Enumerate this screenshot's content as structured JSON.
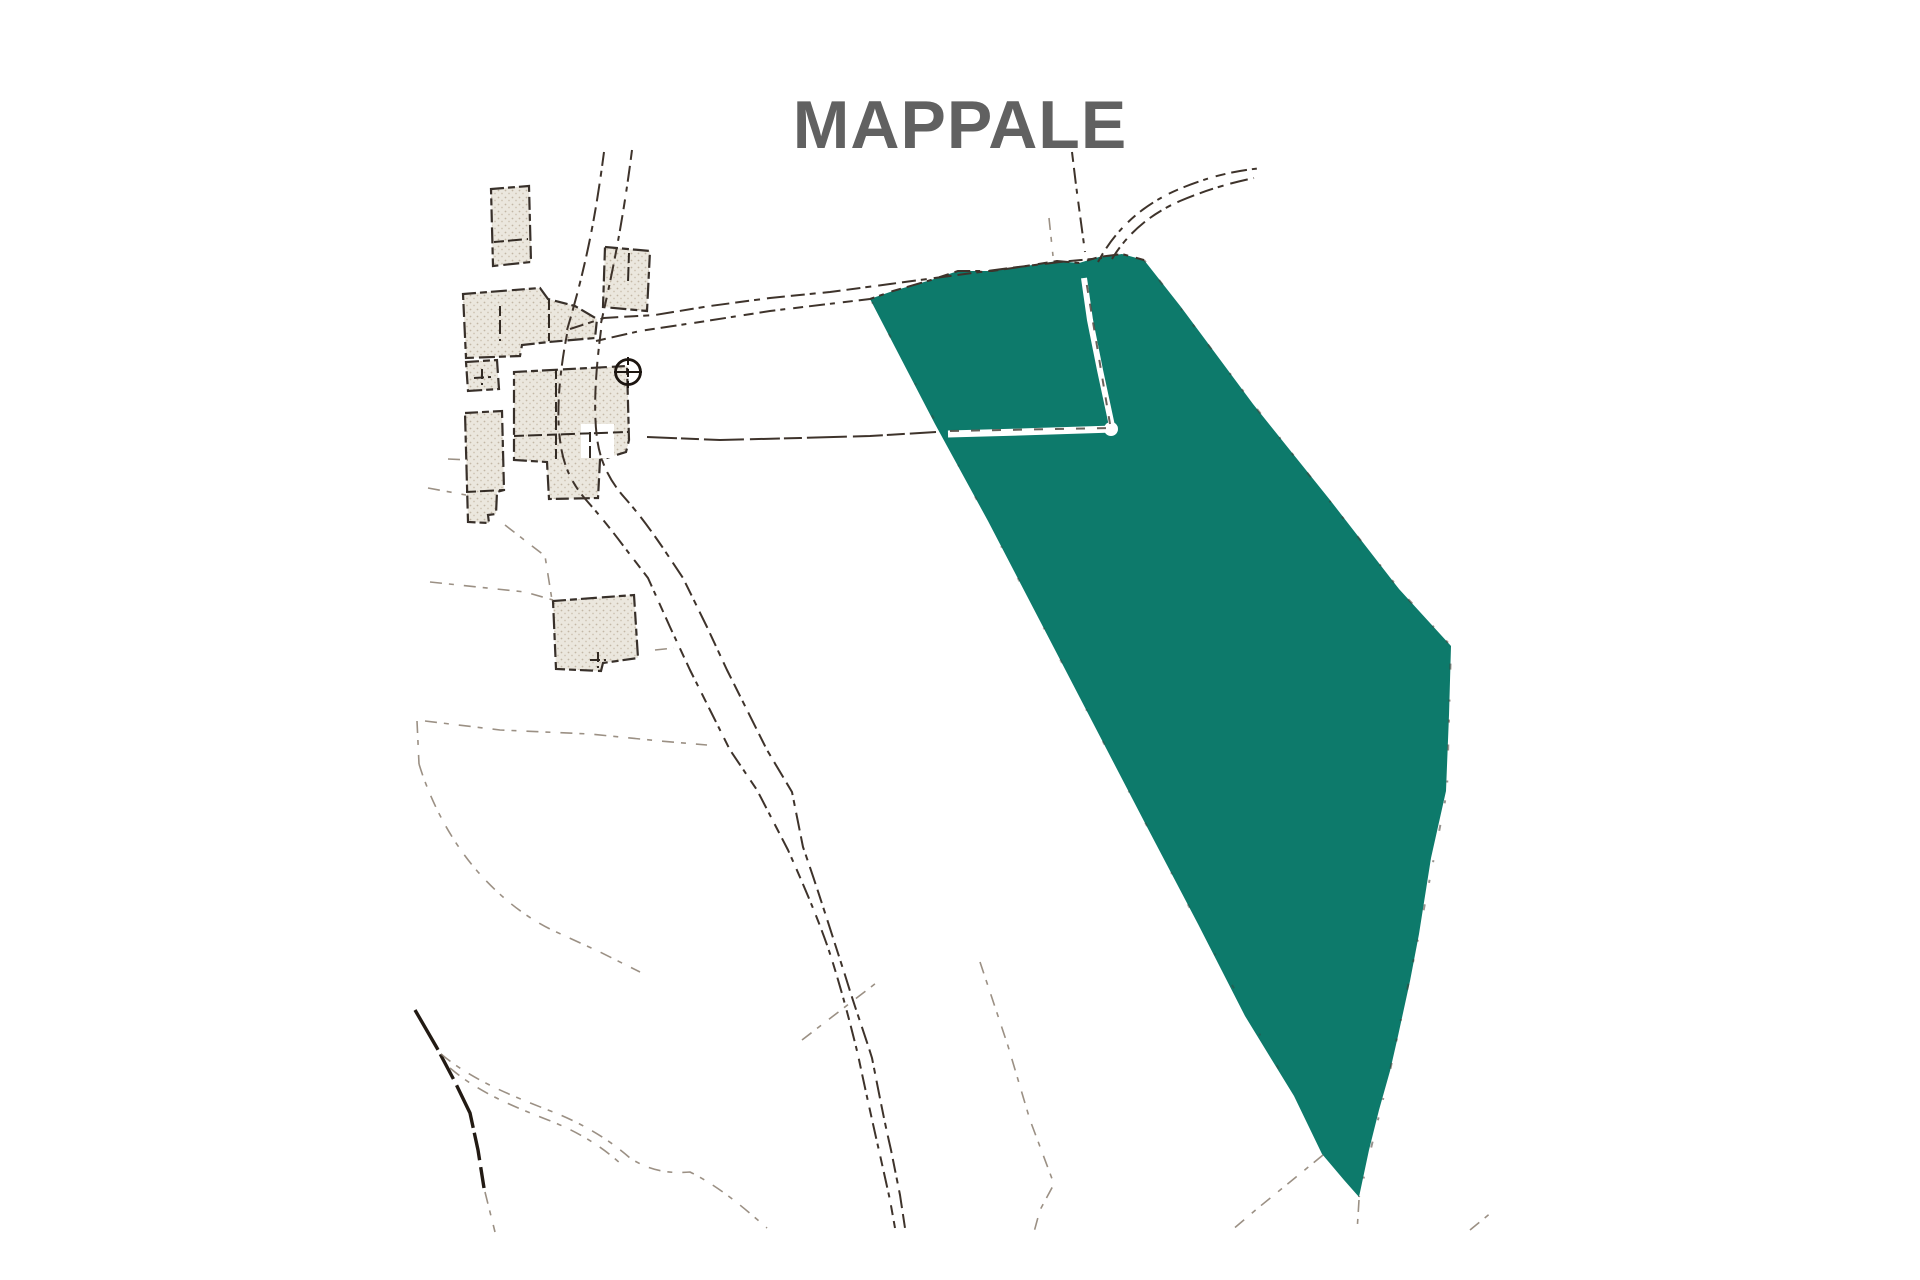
{
  "title": {
    "text": "MAPPALE",
    "color": "#616161"
  },
  "map": {
    "kind": "cadastral-parcel-sketch",
    "background": "#ffffff",
    "parcel_fill": "#0d7a6b",
    "ink_color": "#3e332b",
    "building_fill": "#ebe7de",
    "highlighted_parcel_label": "MAPPALE"
  }
}
